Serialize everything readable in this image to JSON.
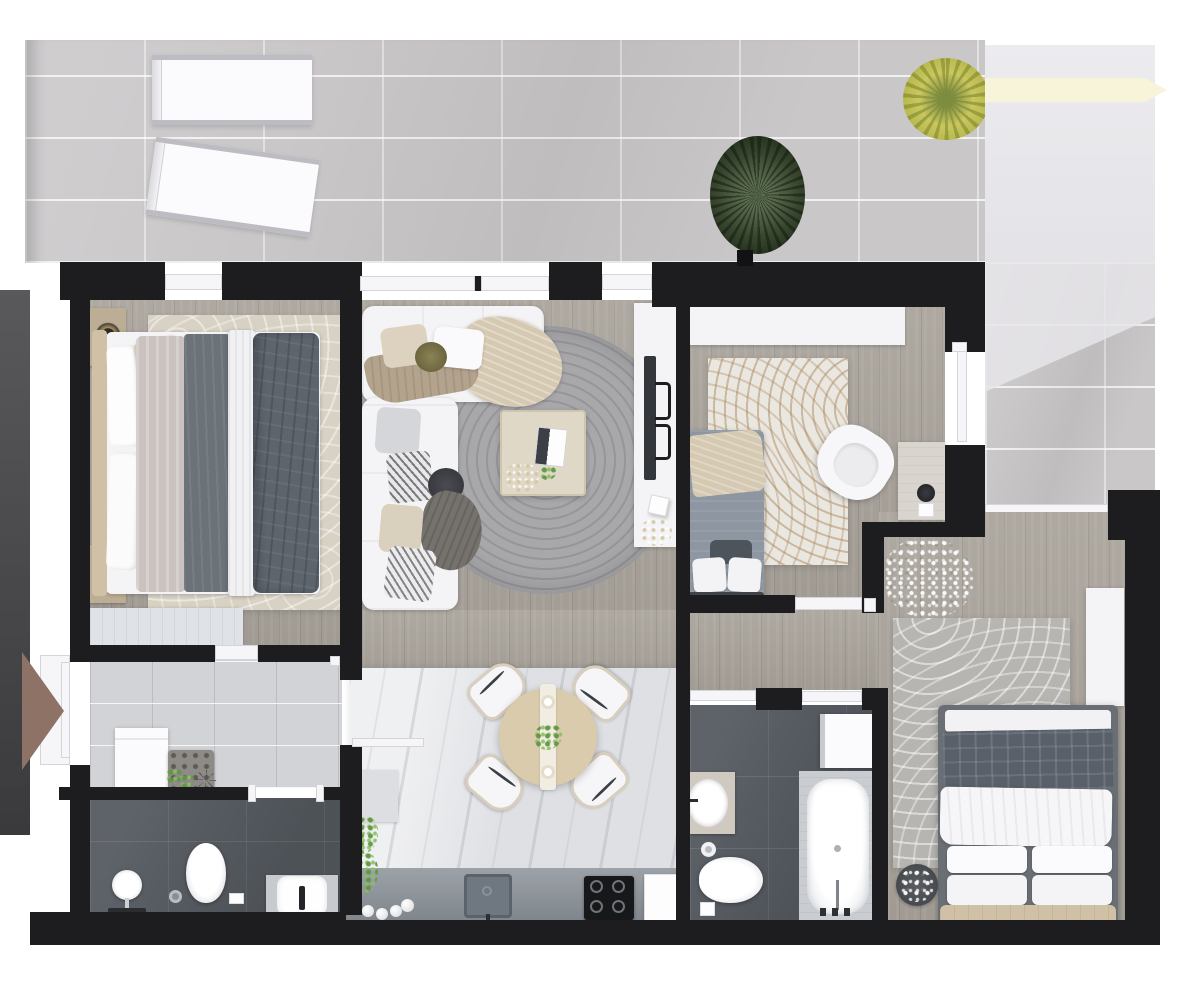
{
  "title": "3D top-down apartment floor plan render",
  "colors": {
    "wall": "#1d1d1f",
    "frameWhite": "#f6f6f8",
    "wood": "#a9a39b",
    "hallTile": "#d2d3d6",
    "darkTile": "#565b61",
    "terraceTile": "#cac7c9",
    "kitchenFloor": "#dfe0e4",
    "counter": "#8e959c",
    "sofaWhite": "#f4f4f6",
    "duvetDark": "#5d646c",
    "duvetLight": "#c9c2bf",
    "headboardBeige": "#cfc0a6",
    "throwBeige": "#d6c9b2",
    "rugBeige": "#d8d2c4",
    "rugKids": "#eae6e0",
    "rugGray": "#b7b5b1",
    "entryArrow": "#8d7265",
    "palmGreen": "#39462f",
    "flowerYellow": "#c9c75f",
    "glassPanel": "#e6e5e9",
    "creamStripe": "#f7f4da",
    "tableWood": "#d9cbab",
    "stoveBlack": "#17181a"
  },
  "plan": {
    "rooms": [
      {
        "id": "balcony-top",
        "name": "Top terrace",
        "floor": "light gray marble tile",
        "furniture": [
          "sun lounger",
          "sun lounger (tilted)",
          "palm plant",
          "yellow flowering plant"
        ]
      },
      {
        "id": "balcony-right",
        "name": "Right terrace",
        "floor": "light gray marble tile with glass canopy",
        "furniture": []
      },
      {
        "id": "master-bedroom",
        "name": "Master bedroom",
        "floor": "wood",
        "furniture": [
          "double bed with white/gray striped bedding",
          "headboard",
          "2 nightstands with lamps",
          "beige leaf-pattern rug",
          "bench at foot of bed"
        ]
      },
      {
        "id": "living-room",
        "name": "Living room",
        "floor": "wood",
        "furniture": [
          "white L-shaped sofa with cushions and throws",
          "round braided gray rug",
          "square wooden coffee table with book and plant",
          "white TV console",
          "TV",
          "2 speaker brackets",
          "white cube stool",
          "dried flowers"
        ]
      },
      {
        "id": "dining-kitchen",
        "name": "Kitchen / dining area",
        "floor": "light marble tile",
        "furniture": [
          "round wooden dining table with runner and centerpiece plant",
          "4 white dining chairs",
          "kitchen counter",
          "sink with faucet",
          "black cooktop",
          "cutting board",
          "kitchen cabinet",
          "potted plants",
          "decorative eggs"
        ]
      },
      {
        "id": "kids-bedroom",
        "name": "Second bedroom (kids room)",
        "floor": "wood",
        "furniture": [
          "white wardrobe",
          "single bed with beige throw and pillows",
          "marble-pattern rug",
          "white swivel armchair",
          "desk with stool"
        ]
      },
      {
        "id": "third-bedroom",
        "name": "Third bedroom",
        "floor": "wood",
        "furniture": [
          "double bed with plaid blanket and 4 pillows",
          "beige headboard",
          "gray patterned rug",
          "potted plant",
          "white wardrobe",
          "baby's breath flowers"
        ]
      },
      {
        "id": "hallway",
        "name": "Entrance hall",
        "floor": "light gray tile",
        "furniture": [
          "washing machine / cabinet",
          "tufted bench",
          "small plants",
          "drying rack"
        ]
      },
      {
        "id": "bathroom-1",
        "name": "Bathroom 1",
        "floor": "dark slate tile",
        "furniture": [
          "pedestal sink",
          "toilet",
          "floor drain",
          "vanity washbasin with black faucet"
        ]
      },
      {
        "id": "bathroom-2",
        "name": "Bathroom 2",
        "floor": "dark slate tile",
        "furniture": [
          "washing machine",
          "bathtub with stone surround",
          "vanity sink",
          "toilet",
          "toilet paper roll"
        ]
      },
      {
        "id": "corridor",
        "name": "Corridor",
        "floor": "wood",
        "furniture": []
      }
    ],
    "openings": [
      "entrance door with brown direction arrow (left wall)",
      "master bedroom balcony door",
      "living room window (double)",
      "living room balcony door",
      "master bedroom door to hall",
      "hall-to-kitchen door (open leaf)",
      "bathroom-1 door",
      "kids room door",
      "kids room balcony door (open leaf)",
      "terrace-to-bedroom threshold",
      "bathroom-2 left door",
      "bathroom-2 right door",
      "third bedroom door"
    ]
  }
}
